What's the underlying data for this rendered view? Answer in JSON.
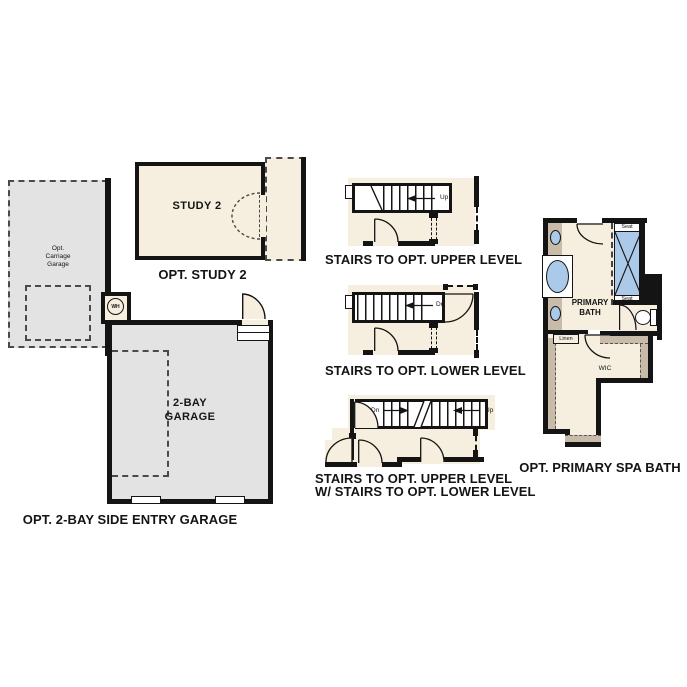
{
  "study": {
    "room_label": "STUDY 2",
    "caption": "OPT. STUDY 2"
  },
  "carriage_garage": {
    "label": "Opt.\nCarriage\nGarage"
  },
  "garage": {
    "room_label": "2-BAY\nGARAGE",
    "caption": "OPT. 2-BAY SIDE ENTRY GARAGE",
    "wh_label": "WH"
  },
  "stairs_upper": {
    "caption": "STAIRS TO OPT. UPPER LEVEL",
    "direction_label": "Up"
  },
  "stairs_lower": {
    "caption": "STAIRS TO OPT. LOWER LEVEL",
    "direction_label": "Dn"
  },
  "stairs_combo": {
    "caption_line1": "STAIRS TO OPT. UPPER LEVEL",
    "caption_line2": "W/ STAIRS TO OPT. LOWER LEVEL",
    "down_label": "Dn",
    "up_label": "Up"
  },
  "bath": {
    "room_label": "PRIMARY\nBATH",
    "wic_label": "WIC",
    "linen_label": "Linen",
    "seat_top_label": "Seat",
    "seat_bottom_label": "Seat",
    "caption": "OPT. PRIMARY SPA BATH"
  },
  "colors": {
    "room_fill": "#f6eede",
    "garage_fill": "#e3e3e3",
    "counter_fill": "#c8bca8",
    "fixture_fill": "#abc9e8",
    "wall": "#141414",
    "background": "#ffffff"
  }
}
